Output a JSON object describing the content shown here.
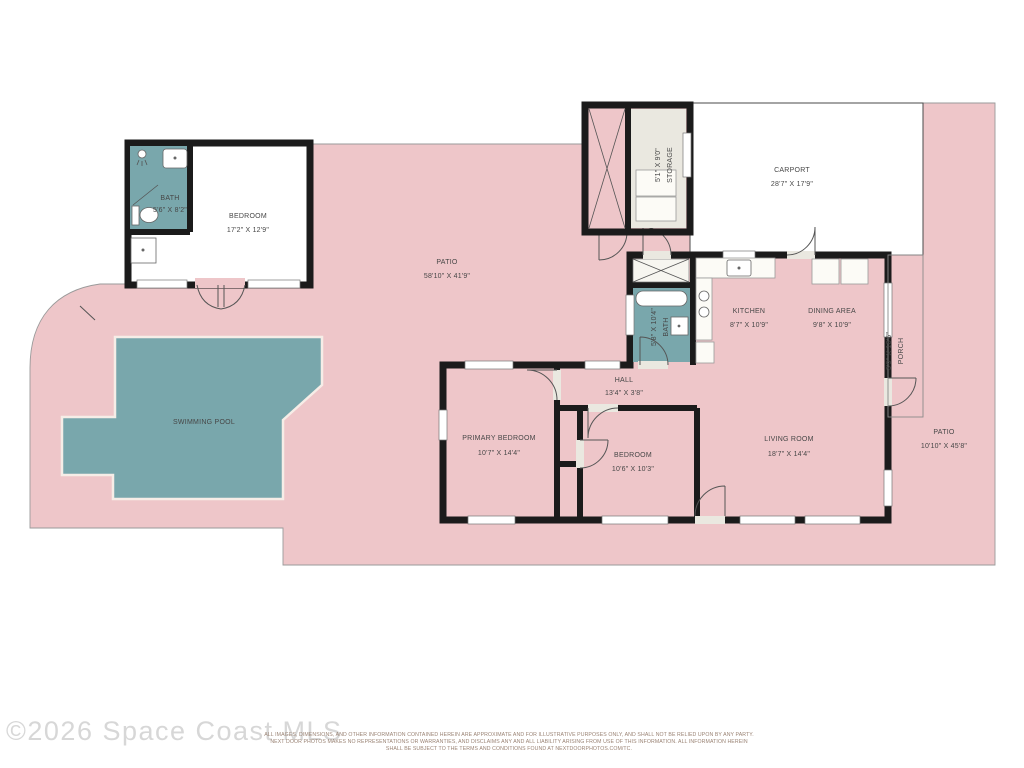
{
  "colors": {
    "patio": "#eec6c9",
    "patio_outline": "#9a9a9a",
    "pool": "#79a7ac",
    "pool_outline": "#f6ede7",
    "floor": "#eae8e0",
    "wall": "#1b1b1b",
    "label": "#474747",
    "watermark": "#d7d7d7",
    "disclaimer": "#9a8374"
  },
  "rooms": {
    "bath1": {
      "name": "BATH",
      "dims": "5'6\" X 8'2\""
    },
    "bedroom1": {
      "name": "BEDROOM",
      "dims": "17'2\" X 12'9\""
    },
    "patio_main": {
      "name": "PATIO",
      "dims": "58'10\" X 41'9\""
    },
    "storage": {
      "name": "STORAGE",
      "dims": "5'1\" X 9'0\""
    },
    "carport": {
      "name": "CARPORT",
      "dims": "28'7\" X 17'9\""
    },
    "kitchen": {
      "name": "KITCHEN",
      "dims": "8'7\" X 10'9\""
    },
    "dining": {
      "name": "DINING AREA",
      "dims": "9'8\" X 10'9\""
    },
    "bath2": {
      "name": "BATH",
      "dims": "5'8\" X 10'4\""
    },
    "hall": {
      "name": "HALL",
      "dims": "13'4\" X 3'8\""
    },
    "primary": {
      "name": "PRIMARY BEDROOM",
      "dims": "10'7\" X 14'4\""
    },
    "bedroom2": {
      "name": "BEDROOM",
      "dims": "10'6\" X 10'3\""
    },
    "living": {
      "name": "LIVING ROOM",
      "dims": "18'7\" X 14'4\""
    },
    "porch": {
      "name": "PORCH",
      "dims": "3'9\" X 16'6\""
    },
    "patio_right": {
      "name": "PATIO",
      "dims": "10'10\" X 45'8\""
    },
    "pool": {
      "name": "SWIMMING POOL"
    }
  },
  "watermark": "©2026 Space Coast MLS",
  "disclaimer": {
    "line1": "ALL IMAGES, DIMENSIONS, AND OTHER INFORMATION CONTAINED HEREIN ARE APPROXIMATE AND FOR ILLUSTRATIVE PURPOSES ONLY, AND SHALL NOT BE RELIED UPON BY ANY PARTY.",
    "line2": "NEXT DOOR PHOTOS MAKES NO REPRESENTATIONS OR WARRANTIES, AND DISCLAIMS ANY AND ALL LIABILITY ARISING FROM USE OF THIS INFORMATION. ALL INFORMATION HEREIN",
    "line3": "SHALL BE SUBJECT TO THE TERMS AND CONDITIONS FOUND AT NEXTDOORPHOTOS.COM/TC."
  }
}
